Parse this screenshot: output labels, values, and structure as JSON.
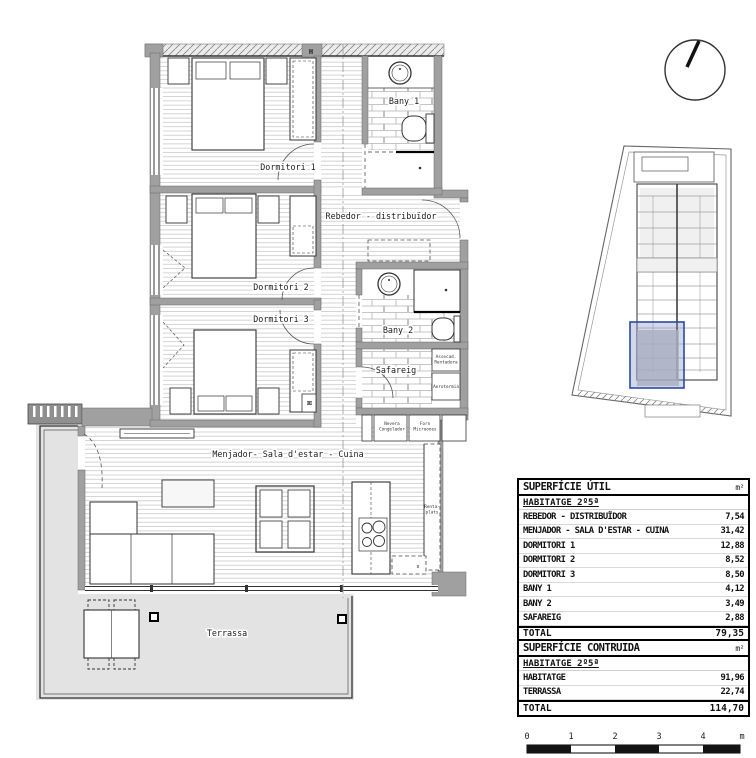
{
  "plan": {
    "rooms": {
      "dormitori1": "Dormitori 1",
      "dormitori2": "Dormitori 2",
      "dormitori3": "Dormitori 3",
      "bany1": "Bany 1",
      "bany2": "Bany 2",
      "rebedor": "Rebedor - distribuïdor",
      "safareig": "Safareig",
      "menjador": "Menjador- Sala d'estar - Cuina",
      "terrassa": "Terrassa"
    },
    "labels": {
      "nevera_1": "Nevera",
      "nevera_2": "Congelador",
      "forn_1": "Forn",
      "forn_2": "Microones",
      "assecad_1": "Assecad.",
      "assecad_2": "Rentadora",
      "aerotermia": "Aerotermia",
      "rentaplats_1": "Renta-",
      "rentaplats_2": "plats",
      "sink": "s",
      "h_marker": "H"
    },
    "colors": {
      "wall": "#a0a0a0",
      "terrace": "#e3e3e3",
      "highlight_fill": "#7d90c4",
      "highlight_border": "#2d4a9e"
    }
  },
  "tables": {
    "util": {
      "title": "SUPERFÍCIE ÚTIL",
      "unit": "m²",
      "subtitle": "HABITATGE 2º5ª",
      "rows": [
        {
          "label": "REBEDOR - DISTRIBUÏDOR",
          "value": "7,54"
        },
        {
          "label": "MENJADOR - SALA D'ESTAR - CUINA",
          "value": "31,42"
        },
        {
          "label": "DORMITORI 1",
          "value": "12,88"
        },
        {
          "label": "DORMITORI 2",
          "value": "8,52"
        },
        {
          "label": "DORMITORI 3",
          "value": "8,50"
        },
        {
          "label": "BANY 1",
          "value": "4,12"
        },
        {
          "label": "BANY 2",
          "value": "3,49"
        },
        {
          "label": "SAFAREIG",
          "value": "2,88"
        }
      ],
      "total": {
        "label": "TOTAL",
        "value": "79,35"
      }
    },
    "built": {
      "title": "SUPERFÍCIE CONTRUIDA",
      "unit": "m²",
      "subtitle": "HABITATGE 2º5ª",
      "rows": [
        {
          "label": "HABITATGE",
          "value": "91,96"
        },
        {
          "label": "TERRASSA",
          "value": "22,74"
        }
      ],
      "total": {
        "label": "TOTAL",
        "value": "114,70"
      }
    }
  },
  "scalebar": {
    "ticks": [
      "0",
      "1",
      "2",
      "3",
      "4"
    ],
    "unit": "m"
  }
}
